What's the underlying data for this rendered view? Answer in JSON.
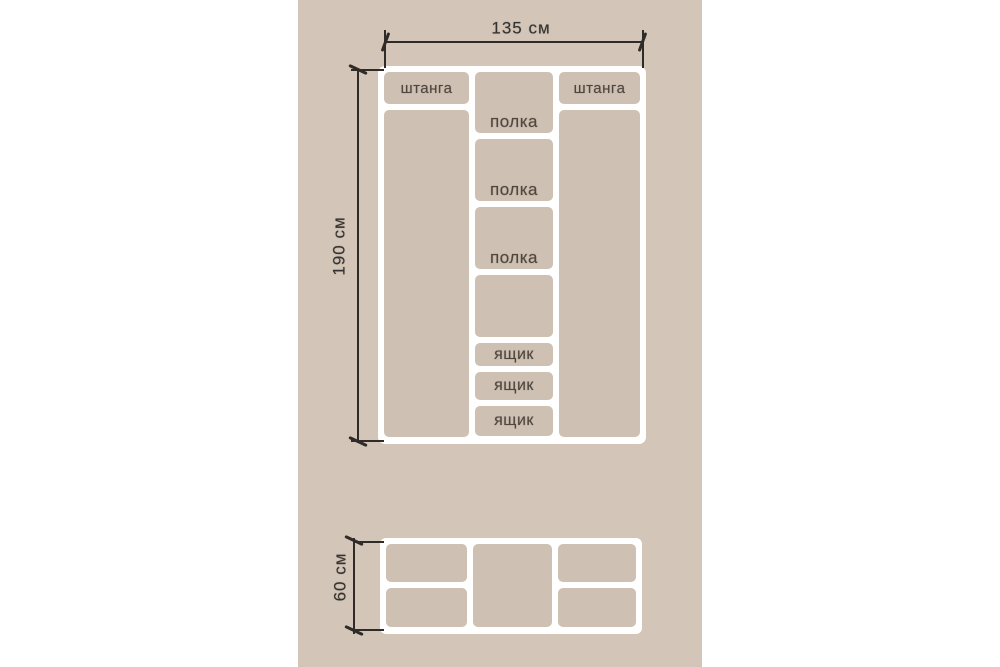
{
  "palette": {
    "page_bg": "#ffffff",
    "panel_bg": "#d3c5b7",
    "cell_bg": "#cec0b2",
    "line_white": "#ffffff",
    "dim_line": "#2e2b28",
    "label_text": "#4f463e",
    "dim_text": "#343230"
  },
  "front_view": {
    "width_label": "135 см",
    "height_label": "190 см",
    "left_column": {
      "rod_label": "штанга"
    },
    "right_column": {
      "rod_label": "штанга"
    },
    "middle_column": {
      "shelf_labels": [
        "полка",
        "полка",
        "полка"
      ],
      "drawer_labels": [
        "ящик",
        "ящик",
        "ящик"
      ]
    }
  },
  "top_view": {
    "depth_label": "60 см"
  }
}
